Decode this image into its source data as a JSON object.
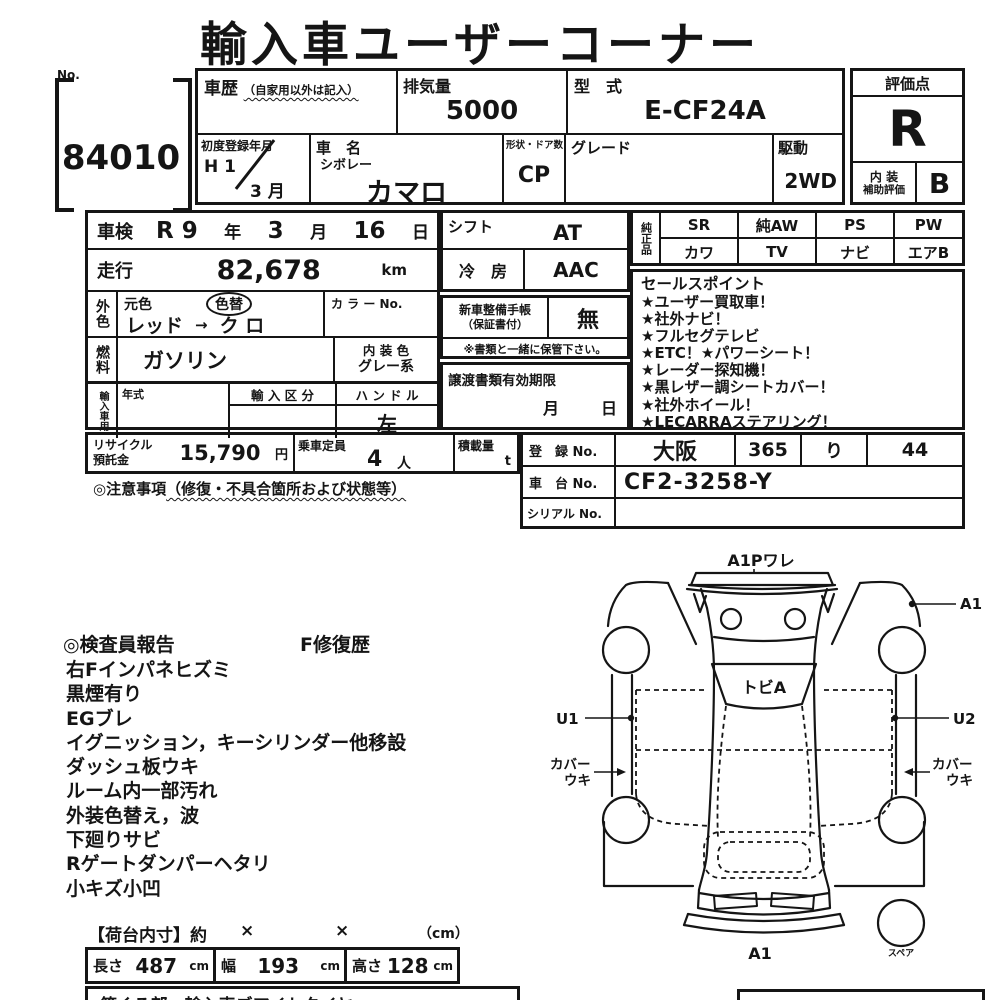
{
  "title": "輸入車ユーザーコーナー",
  "header": {
    "no_label": "No.",
    "no_value": "84010",
    "shareki_label": "車歴",
    "shareki_note": "（自家用以外は記入）",
    "haikiryo_label": "排気量",
    "haikiryo_value": "5000",
    "katashiki_label": "型　式",
    "katashiki_value": "E-CF24A",
    "first_reg_label": "初度登録年月",
    "first_reg_year": "H 1",
    "first_reg_month": "3 月",
    "car_name_label": "車　名",
    "car_maker": "シボレー",
    "car_model": "カマロ",
    "shape_label": "形状・ドア数",
    "shape_value": "CP",
    "grade_label": "グレード",
    "drive_label": "駆動",
    "drive_value": "2WD",
    "score_label": "評価点",
    "score_value": "R",
    "interior_label_1": "内 装",
    "interior_label_2": "補助評価",
    "interior_value": "B"
  },
  "left": {
    "shaken_label": "車検",
    "shaken_era": "R 9",
    "shaken_era_u": "年",
    "shaken_month": "3",
    "shaken_month_u": "月",
    "shaken_day": "16",
    "shaken_day_u": "日",
    "soko_label": "走行",
    "soko_value": "82,678",
    "soko_unit": "km",
    "gaishoku_label": "外色",
    "motoiro_label": "元色",
    "irokae_label": "色替",
    "color_from": "レッド",
    "color_arrow": "→",
    "color_to": "ク ロ",
    "color_no_label": "カ ラ ー No.",
    "nenryo_label": "燃料",
    "nenryo_value": "ガソリン",
    "naiso_label": "内 装 色",
    "naiso_value": "グレー系",
    "import_label": "輸入車用",
    "nenshiki_label": "年式",
    "kubun_label": "輸 入 区 分",
    "handle_label": "ハ ン ド ル",
    "handle_value": "左"
  },
  "mid": {
    "shift_label": "シフト",
    "shift_value": "AT",
    "aircon_label": "冷　房",
    "aircon_value": "AAC",
    "techo_label_1": "新車整備手帳",
    "techo_label_2": "（保証書付）",
    "techo_value": "無",
    "note": "※書類と一緒に保管下さい。",
    "joto_label": "譲渡書類有効期限",
    "joto_month": "月",
    "joto_day": "日"
  },
  "junsei": {
    "label": "純正品",
    "cells": [
      "SR",
      "純AW",
      "PS",
      "PW",
      "カワ",
      "TV",
      "ナビ",
      "エアB"
    ]
  },
  "sales": {
    "title": "セールスポイント",
    "points": [
      "★ユーザー買取車！",
      "★社外ナビ！",
      "★フルセグテレビ",
      "★ETC！★パワーシート！",
      "★レーダー探知機！",
      "★黒レザー調シートカバー！",
      "★社外ホイール！",
      "★LECARRAステアリング！"
    ]
  },
  "recycle": {
    "label_1": "リサイクル",
    "label_2": "預託金",
    "value": "15,790",
    "unit": "円",
    "teiin_label": "乗車定員",
    "teiin_value": "4",
    "teiin_unit": "人",
    "sekisai_label": "積載量",
    "sekisai_unit": "t",
    "caution": "◎注意事項",
    "caution_note": "（修復・不具合箇所および状態等）"
  },
  "registration": {
    "toroku_label": "登　録 No.",
    "area": "大阪",
    "class_no": "365",
    "kana": "り",
    "plate_no": "44",
    "shatai_label": "車　台 No.",
    "shatai_value": "CF2-3258-Y",
    "serial_label": "シリアル No."
  },
  "report": {
    "title": "◎検査員報告",
    "repair": "F修復歴",
    "items": [
      "右Fインパネヒズミ",
      "黒煙有り",
      "EGブレ",
      "イグニッション，キーシリンダー他移設",
      "ダッシュ板ウキ",
      "ルーム内一部汚れ",
      "外装色替え，波",
      "下廻りサビ",
      "Rゲートダンパーヘタリ",
      "小キズ小凹"
    ]
  },
  "diagram": {
    "top": "A1Pワレ",
    "right_top": "A1",
    "windshield": "トビA",
    "left_u": "U1",
    "right_u": "U2",
    "cover_left_1": "カバー",
    "cover_left_2": "ウキ",
    "cover_right_1": "カバー",
    "cover_right_2": "ウキ",
    "front": "A1",
    "spare": "スペア"
  },
  "cargo": {
    "title": "【荷台内寸】約",
    "times_1": "×",
    "times_2": "×",
    "unit_note": "（cm）",
    "len_label": "長さ",
    "len_value": "487",
    "len_unit": "cm",
    "wid_label": "幅",
    "wid_value": "193",
    "wid_unit": "cm",
    "hei_label": "高さ",
    "hei_value": "128",
    "hei_unit": "cm",
    "partial_text": "第くる部・輸入車ズアイトタイヤ"
  }
}
